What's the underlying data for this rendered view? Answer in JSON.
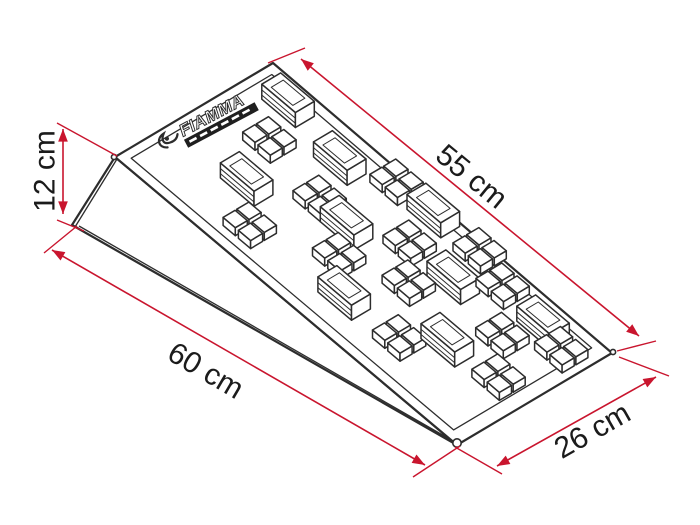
{
  "diagram": {
    "product": {
      "logo_brand": "FIAMMA"
    },
    "dimensions": {
      "height": {
        "label": "12 cm"
      },
      "ramp_surface": {
        "label": "55 cm"
      },
      "base_length": {
        "label": "60 cm"
      },
      "width": {
        "label": "26 cm"
      }
    },
    "colors": {
      "dimension_red": "#c9152e",
      "drawing_line": "#2d2d2d",
      "text_ink": "#1b1b1b",
      "background": "#ffffff"
    }
  }
}
